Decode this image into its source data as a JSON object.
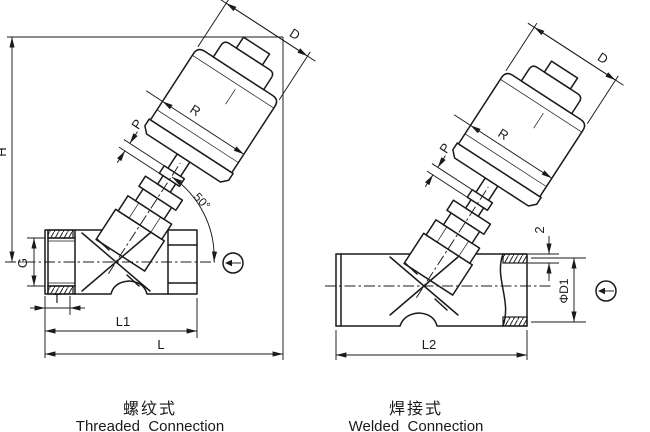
{
  "drawing": {
    "actuator_labels": {
      "diameter": "D",
      "pilot": "P",
      "piston": "R"
    },
    "threaded_figure": {
      "caption_zh": "螺纹式",
      "caption_en": "Threaded  Connection",
      "dim_height": "H",
      "dim_angle": "50°",
      "dim_thread": "G",
      "dim_thread_depth": "T",
      "dim_length_l1": "L1",
      "dim_length_l": "L"
    },
    "welded_figure": {
      "caption_zh": "焊接式",
      "caption_en": "Welded  Connection",
      "dim_wall": "2",
      "dim_bore": "ΦD1",
      "dim_length_l2": "L2"
    }
  }
}
